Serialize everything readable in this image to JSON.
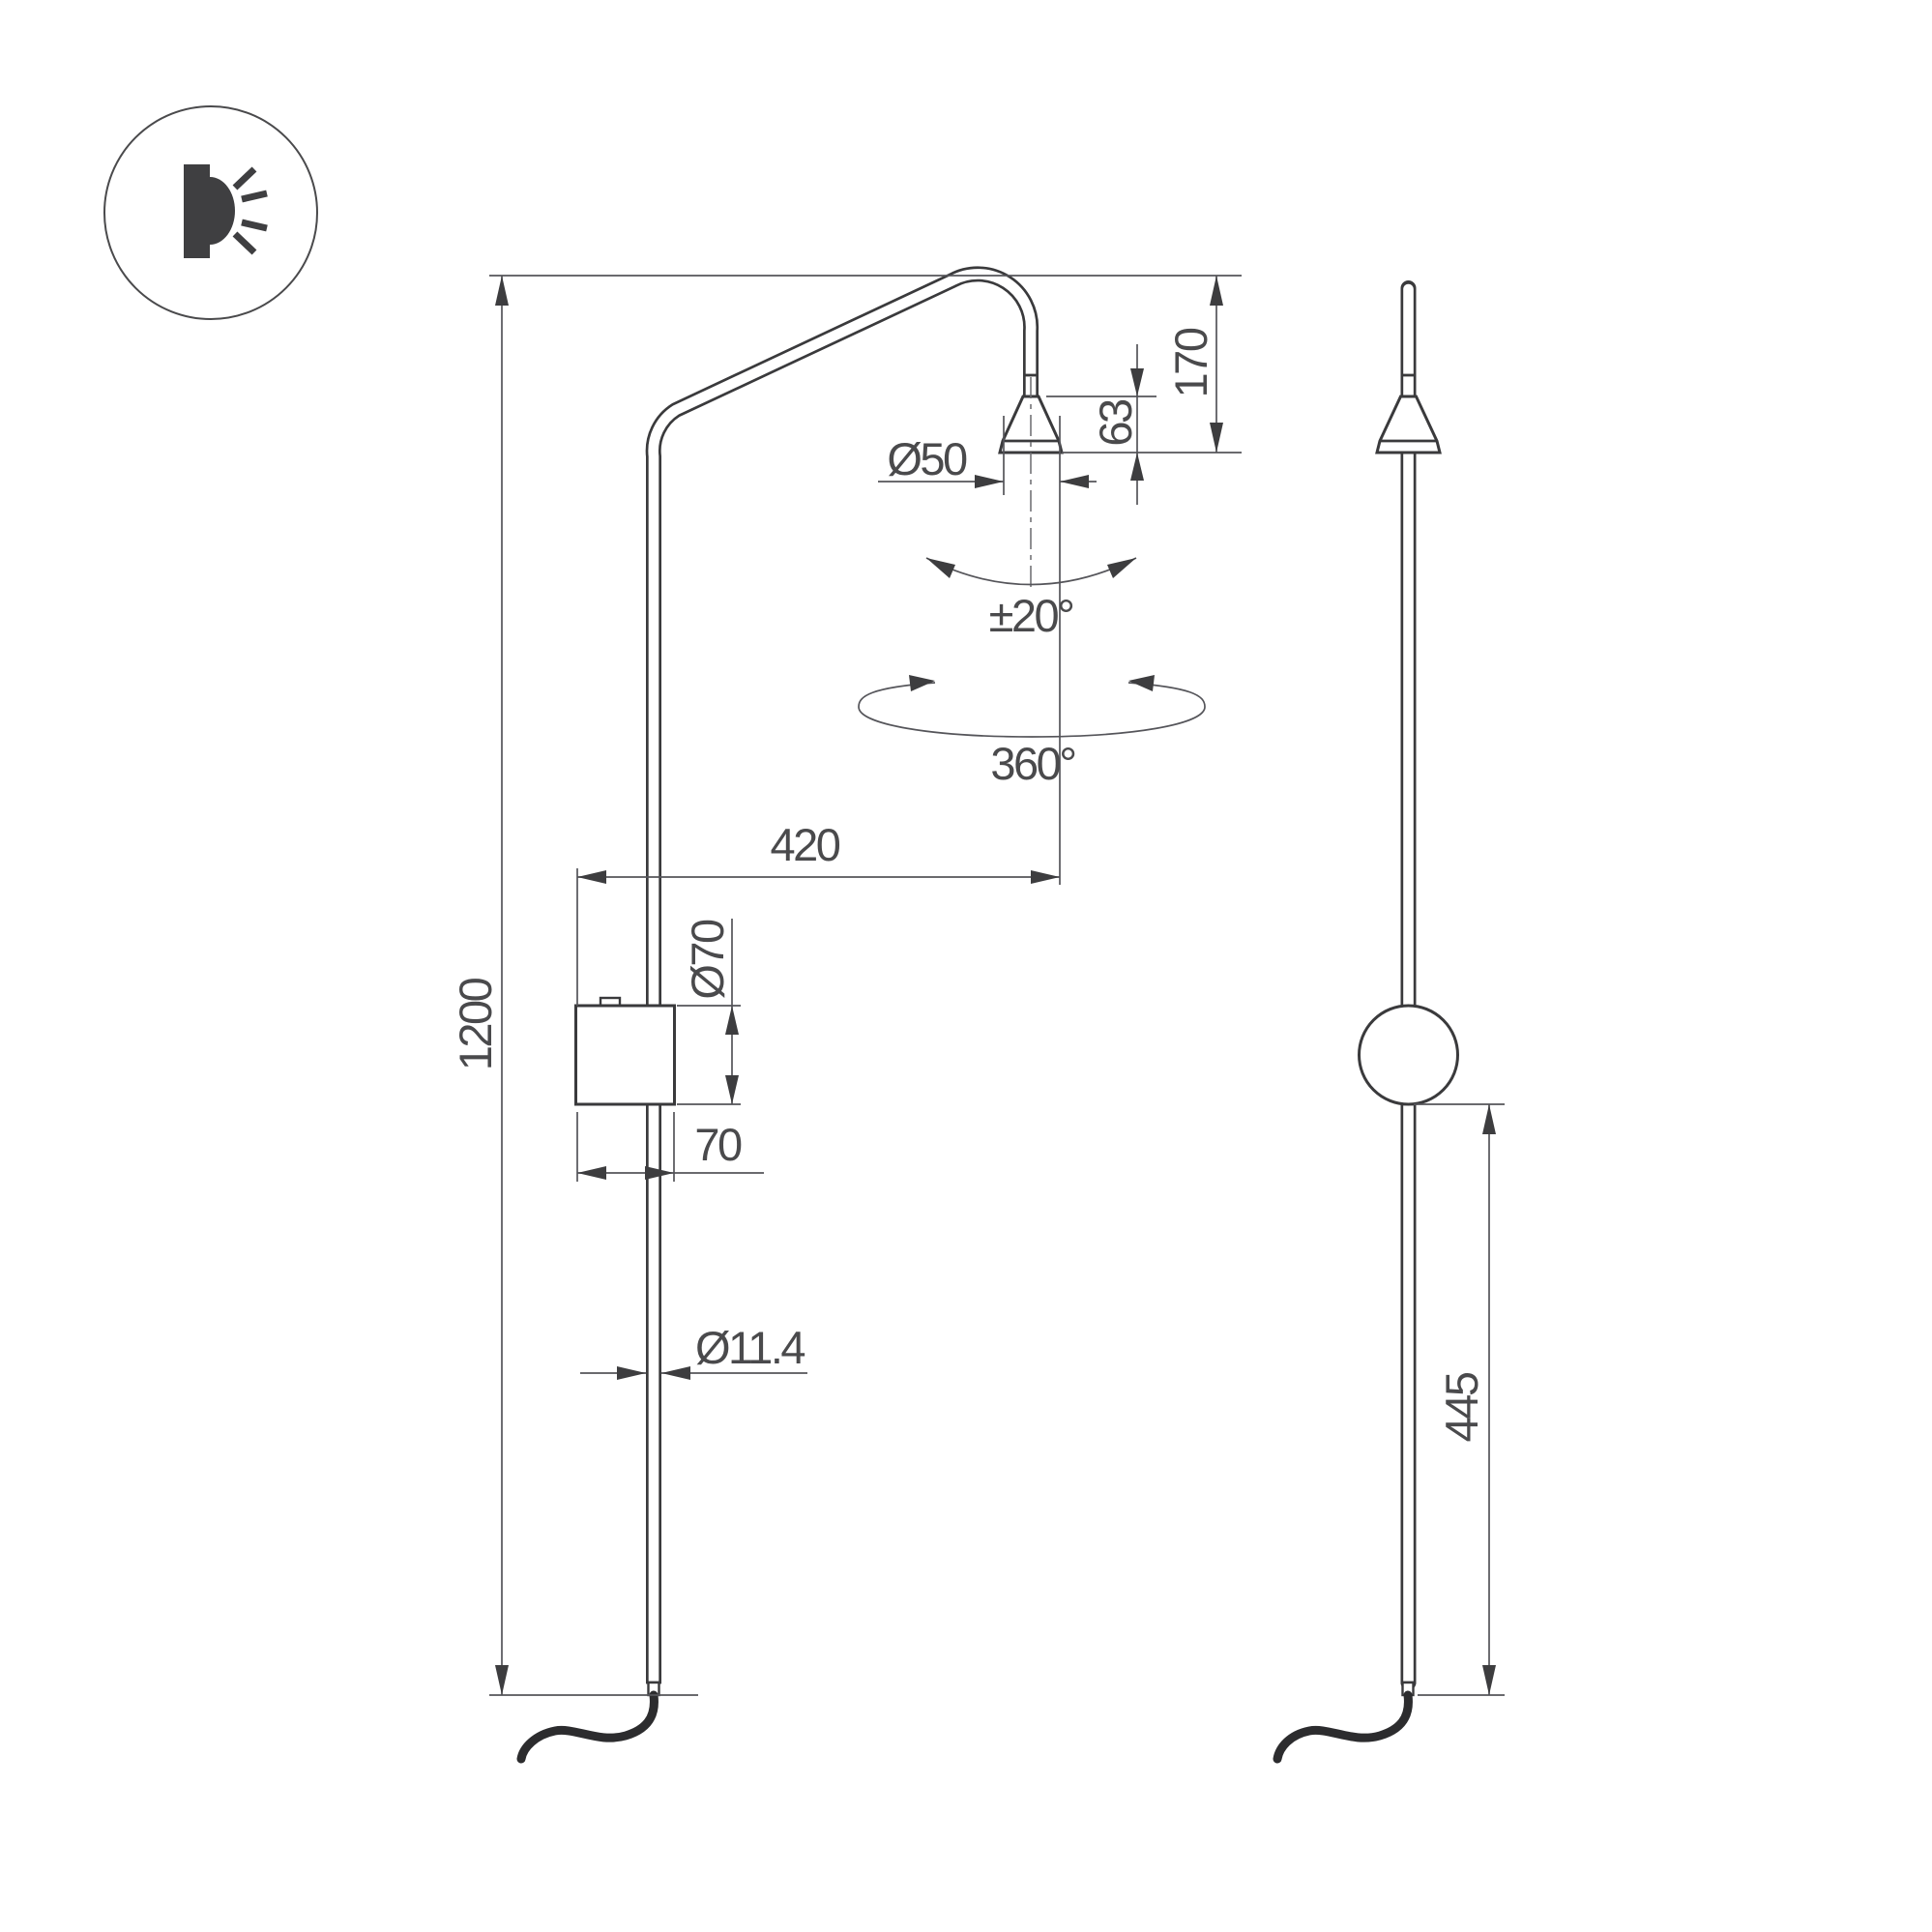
{
  "colors": {
    "background": "#ffffff",
    "object_line": "#3a3a3c",
    "dimension_line": "#55555a",
    "text": "#4a4a4c",
    "cable": "#2c2c2e"
  },
  "icon": {
    "name": "wall-light-icon"
  },
  "front_view": {
    "labels": {
      "height": "1200",
      "reach": "420",
      "head_diameter": "Ø50",
      "head_height": "63",
      "head_drop": "170",
      "tilt_range": "±20°",
      "rotation_range": "360°",
      "canopy_diameter": "Ø70",
      "canopy_width": "70",
      "tube_diameter": "Ø11.4"
    }
  },
  "side_view": {
    "labels": {
      "canopy_to_tip": "445"
    }
  }
}
